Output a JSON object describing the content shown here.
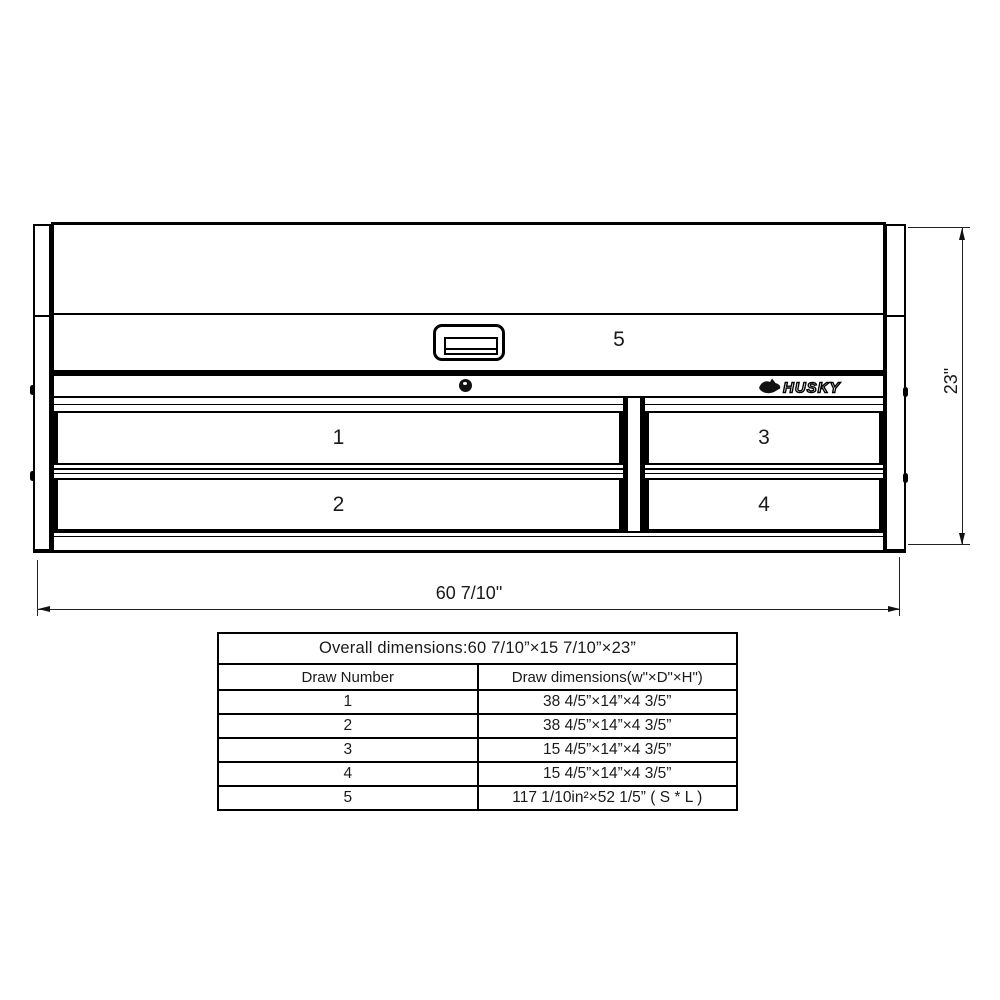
{
  "drawing": {
    "labels": {
      "top": "5",
      "d1": "1",
      "d2": "2",
      "d3": "3",
      "d4": "4"
    },
    "brand": "HUSKY",
    "width_label": "60 7/10\"",
    "height_label": "23\""
  },
  "table": {
    "title": "Overall dimensions:60 7/10”×15 7/10”×23”",
    "headers": [
      "Draw Number",
      "Draw dimensions(w\"×D\"×H\")"
    ],
    "rows": [
      {
        "num": "1",
        "dims": "38 4/5”×14”×4 3/5”"
      },
      {
        "num": "2",
        "dims": "38 4/5”×14”×4 3/5”"
      },
      {
        "num": "3",
        "dims": "15 4/5”×14”×4 3/5”"
      },
      {
        "num": "4",
        "dims": "15 4/5”×14”×4 3/5”"
      },
      {
        "num": "5",
        "dims": "117 1/10in²×52 1/5” ( S * L )"
      }
    ]
  },
  "colors": {
    "line": "#000000",
    "background": "#ffffff"
  }
}
